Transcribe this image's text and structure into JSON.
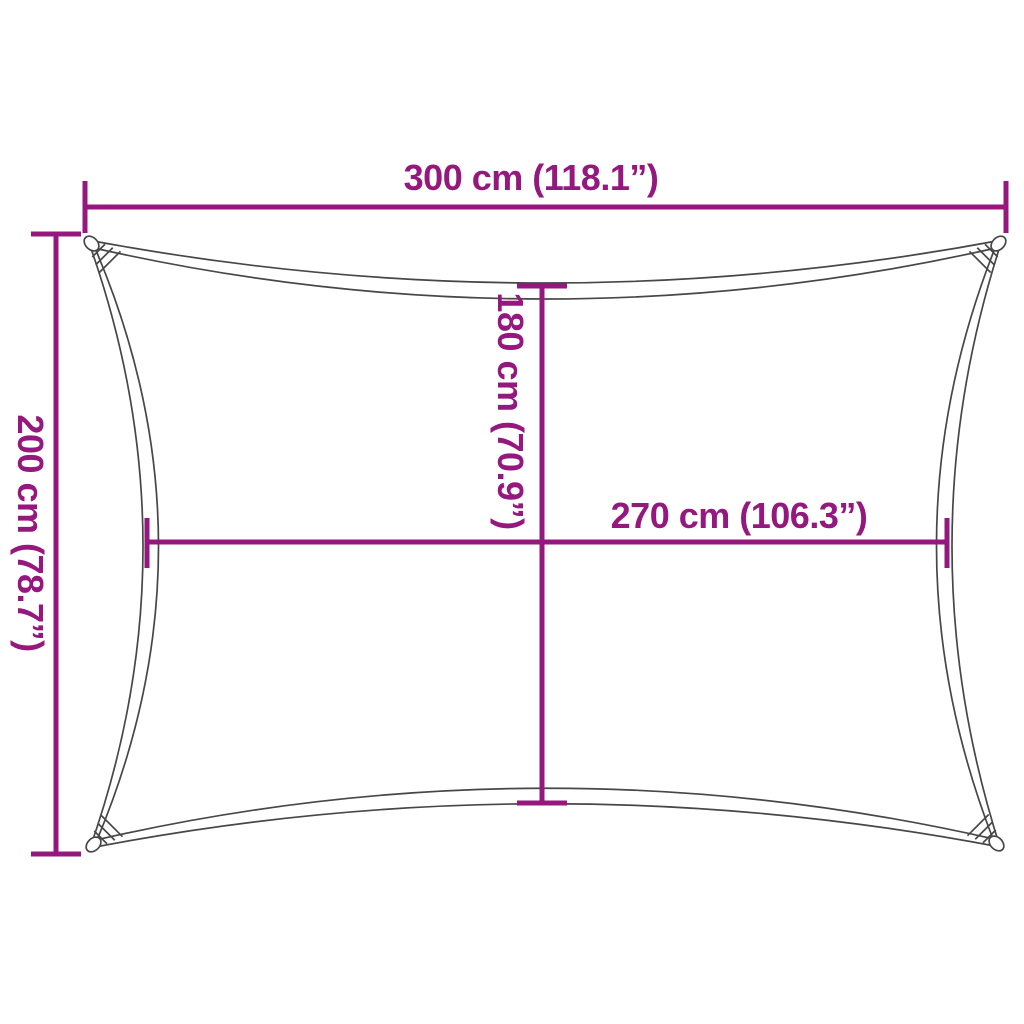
{
  "diagram": {
    "type": "shade-sail-dimension-diagram",
    "dimensions": {
      "top_width": {
        "label": "300 cm (118.1”)",
        "value_cm": 300,
        "value_in": 118.1
      },
      "left_height": {
        "label": "200 cm (78.7”)",
        "value_cm": 200,
        "value_in": 78.7
      },
      "inner_height": {
        "label": "180 cm (70.9”)",
        "value_cm": 180,
        "value_in": 70.9
      },
      "inner_width": {
        "label": "270 cm (106.3”)",
        "value_cm": 270,
        "value_in": 106.3
      }
    },
    "colors": {
      "dimension_lines": "#94187E",
      "sail_outline": "#474747",
      "background": "#FFFFFF"
    }
  }
}
